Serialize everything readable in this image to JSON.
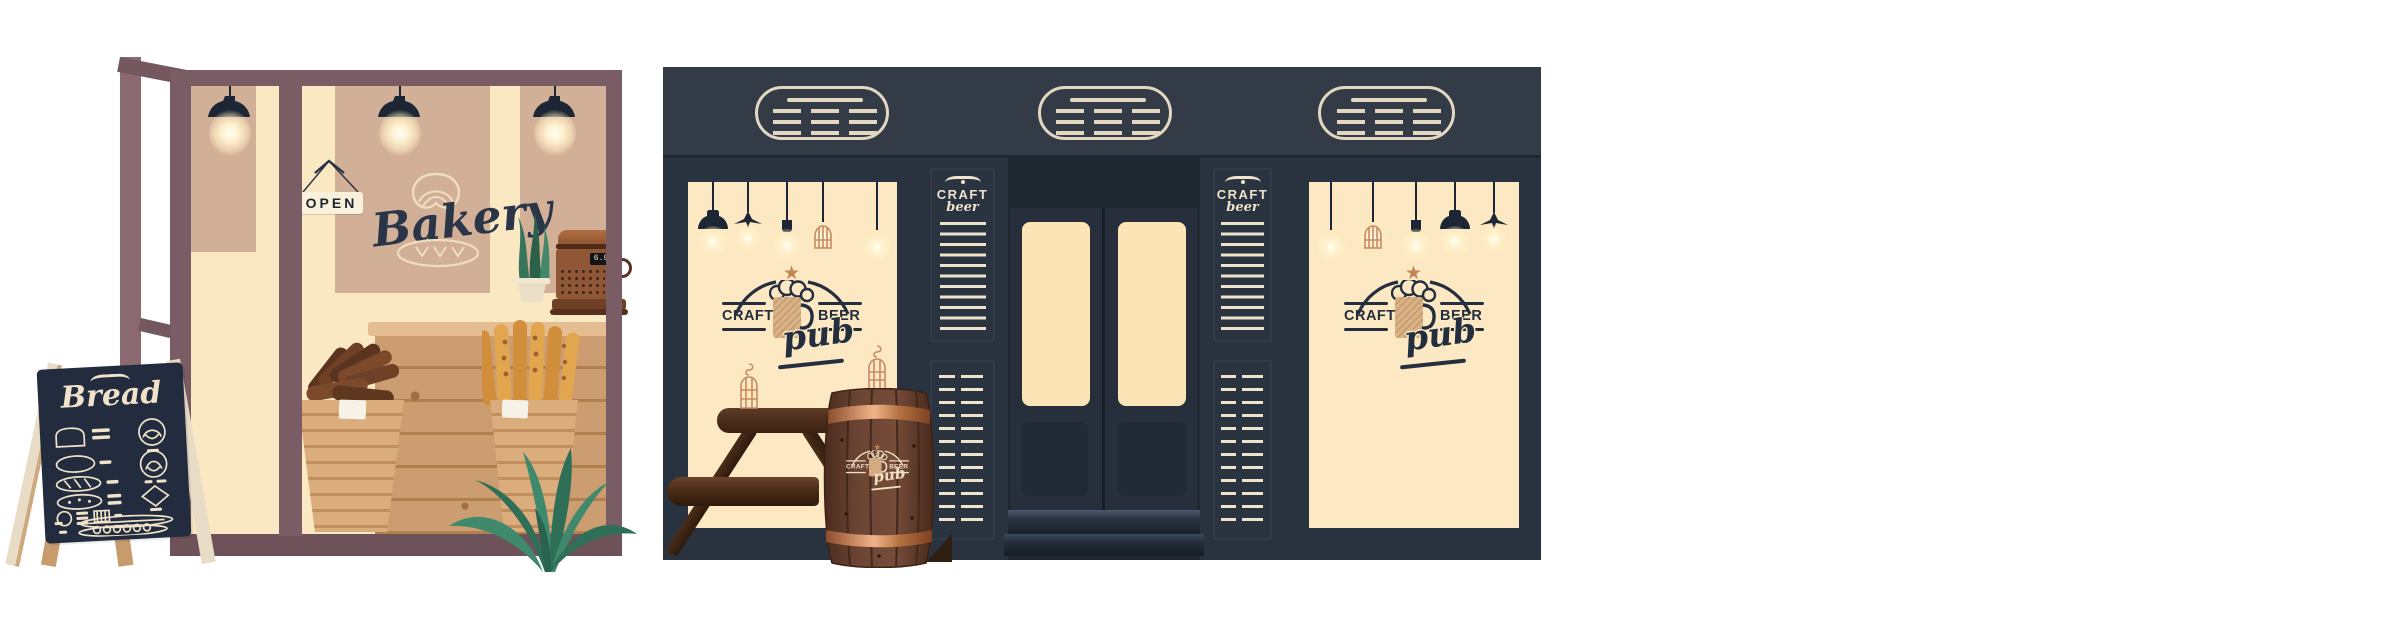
{
  "title": "Bakery and craft beer pub storefronts illustration",
  "bakery": {
    "open_sign": "OPEN",
    "mural_title": "Bakery",
    "chalkboard_title": "Bread",
    "register_display": "6.99"
  },
  "pub": {
    "menu_header": {
      "title": "CRAFT",
      "script": "beer"
    },
    "logo": {
      "left": "CRAFT",
      "right": "BEER",
      "script": "pub"
    }
  },
  "palette": {
    "frame": "#7A5D64",
    "door_frame": "#8A6A70",
    "bakery_cream": "#FAE8C3",
    "panel_tan": "#D2AF97",
    "navy": "#232C3F",
    "chalk": "#F0E3C9",
    "easel_front": "#E9DCC7",
    "easel_back": "#C79B6C",
    "counter_wood": "#CD9D72",
    "counter_line": "#B1804F",
    "counter_top": "#E5BD92",
    "basket": "#DCAD7C",
    "basket_line": "#C28E5D",
    "label": "#F7F2E7",
    "bread_dark": "#6E4126",
    "bread_gold": "#E2A64E",
    "leaf_dark": "#2F6F58",
    "leaf_mid": "#3F8A6D",
    "register_brown": "#8F5736",
    "register_dark": "#6F4026",
    "band": "#333B47",
    "wall": "#29323F",
    "doors_dark": "#1F2731",
    "board_panel": "#2A3340",
    "window_cream": "#FCE8C2",
    "door_window": "#FCE4B6",
    "logo_navy": "#232E3F",
    "logo_tan": "#C28655",
    "copper": "#C68A64",
    "chalk_menu": "#EFE3CB",
    "vent_line": "#E3D7C1",
    "lamp_black": "#1C2634",
    "barrel_wood": "#5E3826"
  }
}
